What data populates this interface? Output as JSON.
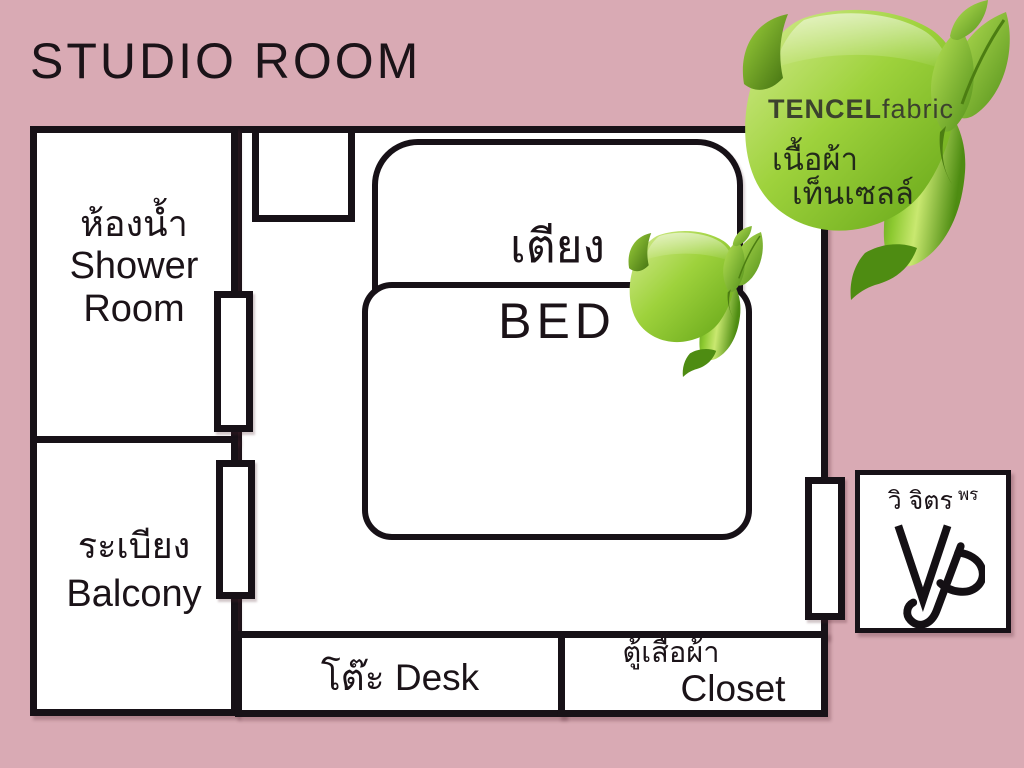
{
  "title": "STUDIO ROOM",
  "plan": {
    "shower_room": {
      "thai": "ห้องน้ำ",
      "en_line1": "Shower",
      "en_line2": "Room"
    },
    "balcony": {
      "thai": "ระเบียง",
      "en": "Balcony"
    },
    "bed": {
      "thai": "เตียง",
      "en": "BED"
    },
    "desk": {
      "thai": "โต๊ะ",
      "en": "Desk"
    },
    "closet": {
      "thai": "ตู้เสื้อผ้า",
      "en": "Closet"
    }
  },
  "tencel_badge": {
    "brand": "TENCEL",
    "brand_suffix": "fabric",
    "thai_line1": "เนื้อผ้า",
    "thai_line2": "เท็นเซลล์"
  },
  "logo": {
    "name_main": "วิ จิตร",
    "name_suffix": "พร",
    "monogram": "VP"
  },
  "colors": {
    "background": "#d9aab4",
    "wall": "#171117",
    "text": "#1b1318",
    "ribbon_light": "#cfe98c",
    "ribbon_mid": "#8ec832",
    "ribbon_dark": "#5f9c15",
    "badge_text": "#3c422e"
  }
}
